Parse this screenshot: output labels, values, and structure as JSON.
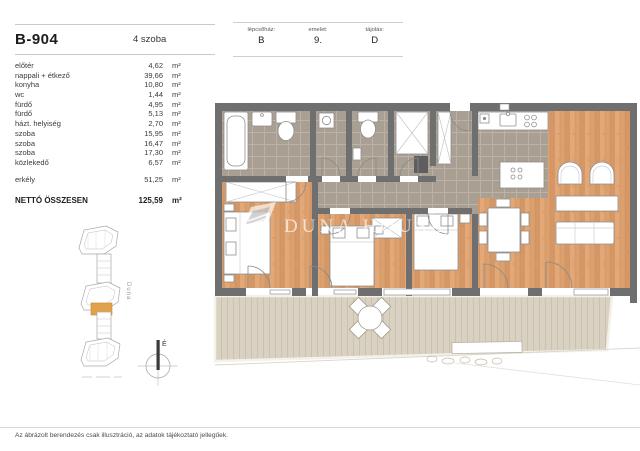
{
  "header": {
    "unit_id": "B-904",
    "room_count_label": "4 szoba"
  },
  "info_table": {
    "cells": [
      {
        "label": "lépcsőház:",
        "value": "B"
      },
      {
        "label": "emelet:",
        "value": "9."
      },
      {
        "label": "tájolás:",
        "value": "D"
      }
    ]
  },
  "room_list": {
    "rows": [
      {
        "label": "előtér",
        "value": "4,62",
        "unit": "m²"
      },
      {
        "label": "nappali + étkező",
        "value": "39,66",
        "unit": "m²"
      },
      {
        "label": "konyha",
        "value": "10,80",
        "unit": "m²"
      },
      {
        "label": "wc",
        "value": "1,44",
        "unit": "m²"
      },
      {
        "label": "fürdő",
        "value": "4,95",
        "unit": "m²"
      },
      {
        "label": "fürdő",
        "value": "5,13",
        "unit": "m²"
      },
      {
        "label": "házt. helyiség",
        "value": "2,70",
        "unit": "m²"
      },
      {
        "label": "szoba",
        "value": "15,95",
        "unit": "m²"
      },
      {
        "label": "szoba",
        "value": "16,47",
        "unit": "m²"
      },
      {
        "label": "szoba",
        "value": "17,30",
        "unit": "m²"
      },
      {
        "label": "közlekedő",
        "value": "6,57",
        "unit": "m²"
      }
    ],
    "balcony_row": {
      "label": "erkély",
      "value": "51,25",
      "unit": "m²"
    },
    "total_row": {
      "label": "NETTÓ ÖSSZESEN",
      "value": "125,59",
      "unit": "m²"
    }
  },
  "site_map": {
    "river_label": "Duna",
    "compass_north_label": "É"
  },
  "watermark": {
    "text": "DUNA HOUSE"
  },
  "footer": {
    "disclaimer": "Az ábrázolt berendezés csak illusztráció, az adatok tájékoztató jellegűek."
  },
  "colors": {
    "wall": "#6f6f6f",
    "tile_floor": "#a99f93",
    "wood_floor": "#dca06e",
    "deck": "#d9d1c1",
    "highlighted_unit": "#e2a24b"
  }
}
